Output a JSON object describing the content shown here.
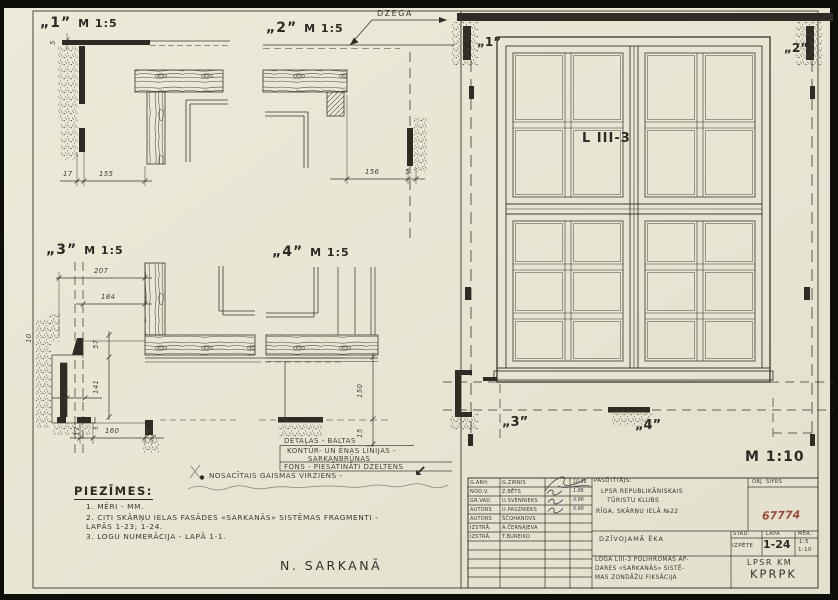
{
  "sheet": {
    "notes_title": "PIEZĪMES:",
    "notes": [
      "1. MĒRI - MM.",
      "2. CITI SKĀRŅU IELAS FASĀDES «SARKANĀS» SISTĒMAS FRAGMENTI - LAPĀS 1-23; 1-24.",
      "3. LOGU NUMERĀCIJA - LAPĀ 1-1."
    ],
    "bottom_label": "N. SARKANĀ"
  },
  "details": {
    "d1": {
      "title": "„1”",
      "scale": "M 1:5",
      "dim_5": "5",
      "dim_17": "17",
      "dim_155": "155"
    },
    "d2": {
      "title": "„2”",
      "scale": "M 1:5",
      "callout": "DZEGA",
      "dim_156": "156",
      "dim_5": "5"
    },
    "d3": {
      "title": "„3”",
      "scale": "M 1:5",
      "dim_207": "207",
      "dim_184": "184",
      "dim_57": "57",
      "dim_141": "141",
      "dim_18": "18",
      "dim_17": "17",
      "dim_160": "160",
      "dim_5a": "5",
      "dim_5b": "5",
      "dim_10": "10"
    },
    "d4": {
      "title": "„4”",
      "scale": "M 1:5",
      "dim_150": "150",
      "dim_15": "15"
    }
  },
  "elevation": {
    "label": "L III-3",
    "scale": "M 1:10",
    "marker1": "„1”",
    "marker2": "„2”",
    "marker3": "„3”",
    "marker4": "„4”"
  },
  "legend": {
    "row1": "DETAĻAS - BALTAS",
    "row2a": "KONTŪR- UN ĒNAS LĪNIJAS -",
    "row2b": "SARKANBRŪNAS",
    "row3": "FONS - PIESĀTINĀTI DZELTENS",
    "light": "NOSACĪTAIS GAISMAS VIRZIENS -",
    "light_arrow": "↙"
  },
  "titleblock": {
    "rows": [
      {
        "role": "G.ARH.",
        "name": "G.ZIRNIS",
        "date": "10.86"
      },
      {
        "role": "NOD.V.",
        "name": "Z.BĒTS",
        "date": "1.86"
      },
      {
        "role": "GR.VAD.",
        "name": "U.SVENNIEKS",
        "date": "X.86"
      },
      {
        "role": "AUTORS",
        "name": "U.PASZNIEKS",
        "date": "X.86"
      },
      {
        "role": "AUTORS",
        "name": "ŠČOHANOVS",
        "date": ""
      },
      {
        "role": "IZSTRĀ.",
        "name": "A.ČERNAJEVA",
        "date": ""
      },
      {
        "role": "IZSTRĀ.",
        "name": "T.BUREIKO",
        "date": ""
      }
    ],
    "customer_label": "PASŪTĪTĀJS:",
    "customer_line1": "LPSR REPUBLIKĀNISKAIS",
    "customer_line2": "TŪRISTU KLUBS",
    "address": "RĪGA, SKĀRŅU IELĀ №22",
    "obj_label": "OBJ. ŠIFRS",
    "obj_code": "67774",
    "building": "DZĪVOJAMĀ ĒKA",
    "col_stage": "STAD.",
    "col_sheet": "LAPA",
    "col_scale": "MĒR.",
    "stage": "IZPĒTE",
    "sheet_no": "1-24",
    "scale_1": "1:5",
    "scale_2": "1:10",
    "desc_line1": "LOGA LIII-3 POLIHROMĀS AP-",
    "desc_line2": "DARES «SARKANĀS» SISTĒ-",
    "desc_line3": "MAS ZONDĀŽU FIKSĀCIJA",
    "org_line1": "LPSR KM",
    "org_line2": "KPRPK",
    "colors": {
      "stamp_red": "#9c4a38",
      "ink": "#3a372c",
      "paper": "#e9e6d5"
    }
  }
}
